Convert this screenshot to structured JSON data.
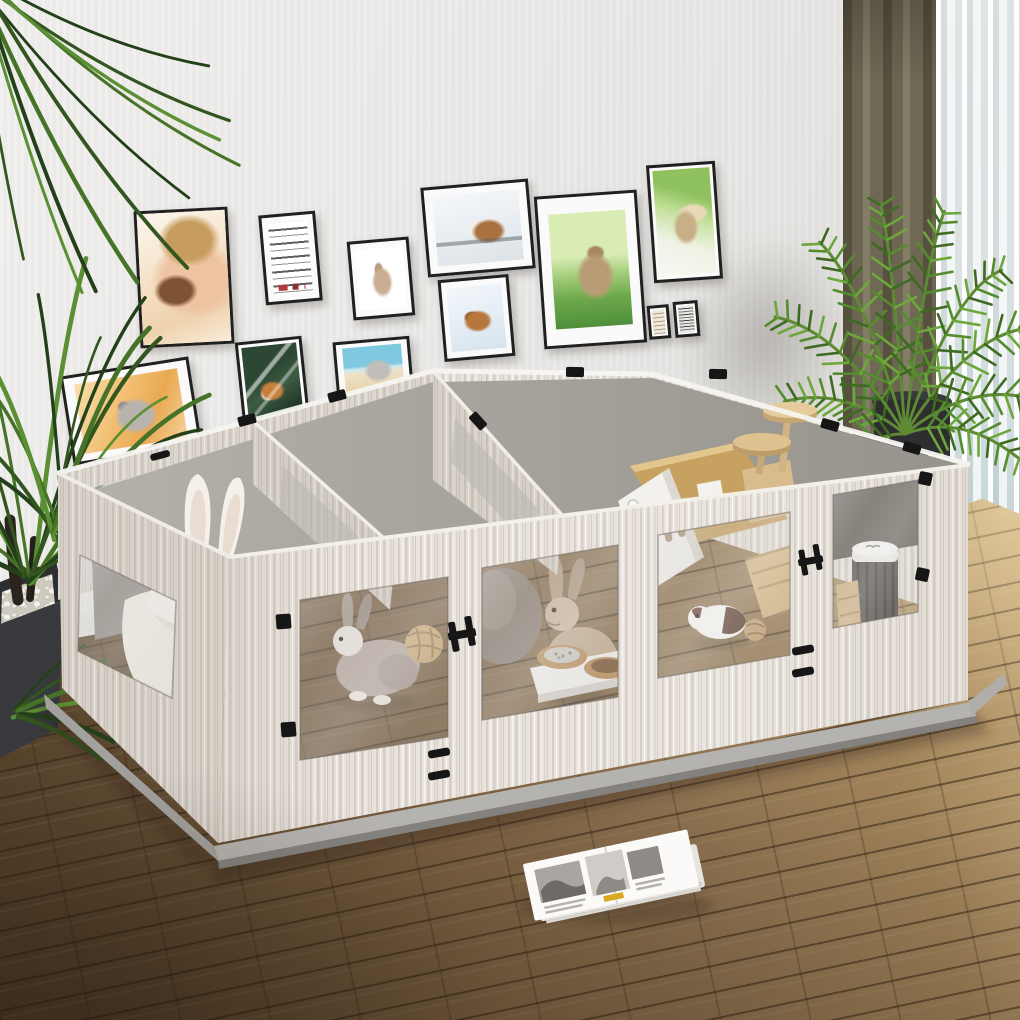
{
  "scene": {
    "description": "Bright living room with a large four-room small-animal playpen on a brown plank wood floor, a gallery wall of framed pet photos, houseplants, curtains and an open magazine on the floor"
  },
  "room": {
    "wall_label": "light gray wall",
    "baseboard_label": "white baseboard",
    "floor_label": "brown wood plank flooring"
  },
  "wall_frames": [
    {
      "name": "girl-with-guinea-pig",
      "label": "Framed photo: girl kissing a guinea pig"
    },
    {
      "name": "typography-poster",
      "label": "Framed mirrored black and red typography poster"
    },
    {
      "name": "rabbit-watercolor",
      "label": "Small framed rabbit watercolor sketch"
    },
    {
      "name": "guinea-pig-windowsill",
      "label": "Framed photo: guinea pig on a windowsill"
    },
    {
      "name": "guinea-pig-snow",
      "label": "Framed photo: guinea pig in snow"
    },
    {
      "name": "rabbit-on-grass",
      "label": "Large framed photo: brown rabbit on green grass"
    },
    {
      "name": "rabbit-held-up",
      "label": "Framed photo: tan rabbit held up against greenery"
    },
    {
      "name": "mini-print-left",
      "label": "Tiny beige text print"
    },
    {
      "name": "mini-print-right",
      "label": "Tiny dense text collage print"
    },
    {
      "name": "chinchilla-portrait",
      "label": "Framed photo: gray chinchilla on warm orange background"
    },
    {
      "name": "guinea-pig-dark",
      "label": "Framed photo: orange and white guinea pig on dark green"
    },
    {
      "name": "chinchilla-beach",
      "label": "Framed photo: chinchilla with blue sky and sand"
    }
  ],
  "enclosure": {
    "label": "DIY four-room small-animal playpen with white-washed wood grain panels, clear acrylic windows, black clips and a gray base tray",
    "compartments": [
      {
        "name": "compartment-1",
        "contents": "white bunny-ear cushion, shredded paper bedding, gray-and-white rabbit, wicker ball"
      },
      {
        "name": "compartment-2",
        "contents": "tan rabbit, raised wooden double feeding bowls with pellets, taupe hideout"
      },
      {
        "name": "compartment-3",
        "contents": "cardboard house, wooden climbing tree with round platforms, wooden ramp, white-and-brown guinea pig, chew ball"
      },
      {
        "name": "compartment-4",
        "contents": "white-lidded cylinder feeder and small wooden steps"
      }
    ],
    "hardware_label": "black corner clips, H-shaped hinges and vent slots",
    "base_label": "gray plastic base tray"
  },
  "plants": [
    {
      "name": "dracaena",
      "label": "Dracaena plant with long arching dark leaves in black pebble-topped planter",
      "position": "left"
    },
    {
      "name": "areca-palm",
      "label": "Areca palm in dark pot by the window",
      "position": "right"
    }
  ],
  "curtains": {
    "dark_label": "floor-length taupe curtain",
    "sheer_label": "white striped sheer curtain"
  },
  "magazine": {
    "label": "open magazine with black-and-white photos lying on the floor"
  },
  "colors": {
    "wall": "#e7e6e4",
    "floor_mid": "#8a6f4e",
    "pen_wood": "#e7e2db",
    "pen_base": "#b5b3af",
    "glass": "#b4b2ae",
    "curtain": "#6e685c",
    "sheer": "#eef1f1",
    "plant_green": "#4c752c",
    "planter": "#333538",
    "hardware": "#161616"
  }
}
